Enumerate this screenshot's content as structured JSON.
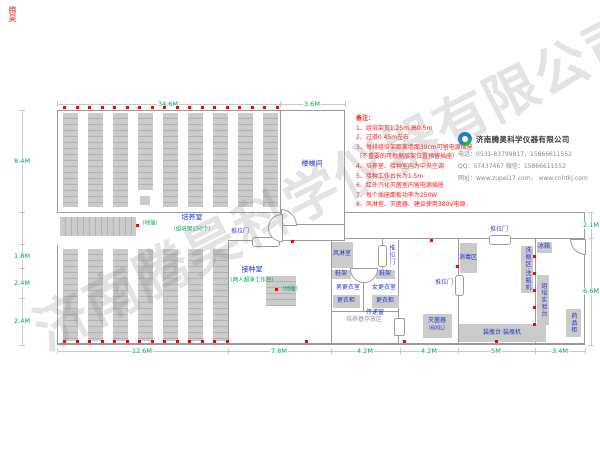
{
  "watermark": {
    "text": "济南腾昊科学仪器有限公司"
  },
  "corner_mark": "腾昊",
  "notes": {
    "title": "备注：",
    "items": [
      "1、组培架宽1.25m,高0.5m",
      "2、过道0.45m左右",
      "3、每排组培架距离墙面30cm可留电源插座",
      "（不重要的可根据层架位置预留插座）",
      "4、培养室、接种室内为中央空调",
      "5、接种工作台长为1.5m",
      "6、红外汽化灭菌室内留电源插座",
      "7、每个插座面板功率为250W",
      "8、风淋室、灭菌器、建议使用380V电源."
    ]
  },
  "company": {
    "name": "济南腾昊科学仪器有限公司",
    "phone": "电话：0531-83799817，15866611552",
    "qq": "QQ：57437467    微信：15866611552",
    "website": "网址：www.zupei17.com，  www.cnhtkj.com"
  },
  "labels": {
    "stairwell": "楼梯间",
    "cultivation": "培养室",
    "cultivation_sub": "（组培架150个）",
    "inoculation": "接种室",
    "inoculation_sub": "（两人超净工作台）",
    "air_shower": "风淋室",
    "mens_changing": "男更衣室",
    "womens_changing": "女更衣室",
    "shoe_rack": "鞋架",
    "locker": "更衣柜",
    "pass_window": "传递窗",
    "medium_storage": "培养基存放区",
    "sterilizer": "灭菌器",
    "sterilizer_spec": "（600L）",
    "bottling_bench": "装瓶台·装瓶机",
    "disinfection_area": "消毒区",
    "fridge": "冰箱",
    "bottle_washing": "洗瓶区·洗瓶机",
    "tc_bench": "组培实验台",
    "medicine_cabinet": "药品柜",
    "sliding_door": "推拉门",
    "floor_socket": "（地插）"
  },
  "dimensions": {
    "top": [
      "34.6M",
      "3.6M"
    ],
    "left": [
      "8.4M",
      "1.8M",
      "2.4M",
      "2.4M"
    ],
    "bottom": [
      "12.6M",
      "7.8M",
      "4.2M",
      "4.2M",
      "5M",
      "3.4M"
    ],
    "right": [
      "2.1M",
      "6.6M"
    ]
  },
  "colors": {
    "room_label": "#2233cc",
    "note_text": "#ff1a1a",
    "dimension_text": "#00a651",
    "door_label": "#5a3fd8",
    "wall": "#9b9b9b",
    "outlet_dot": "#ff0000",
    "rack_fill": "#cbcbcb"
  }
}
